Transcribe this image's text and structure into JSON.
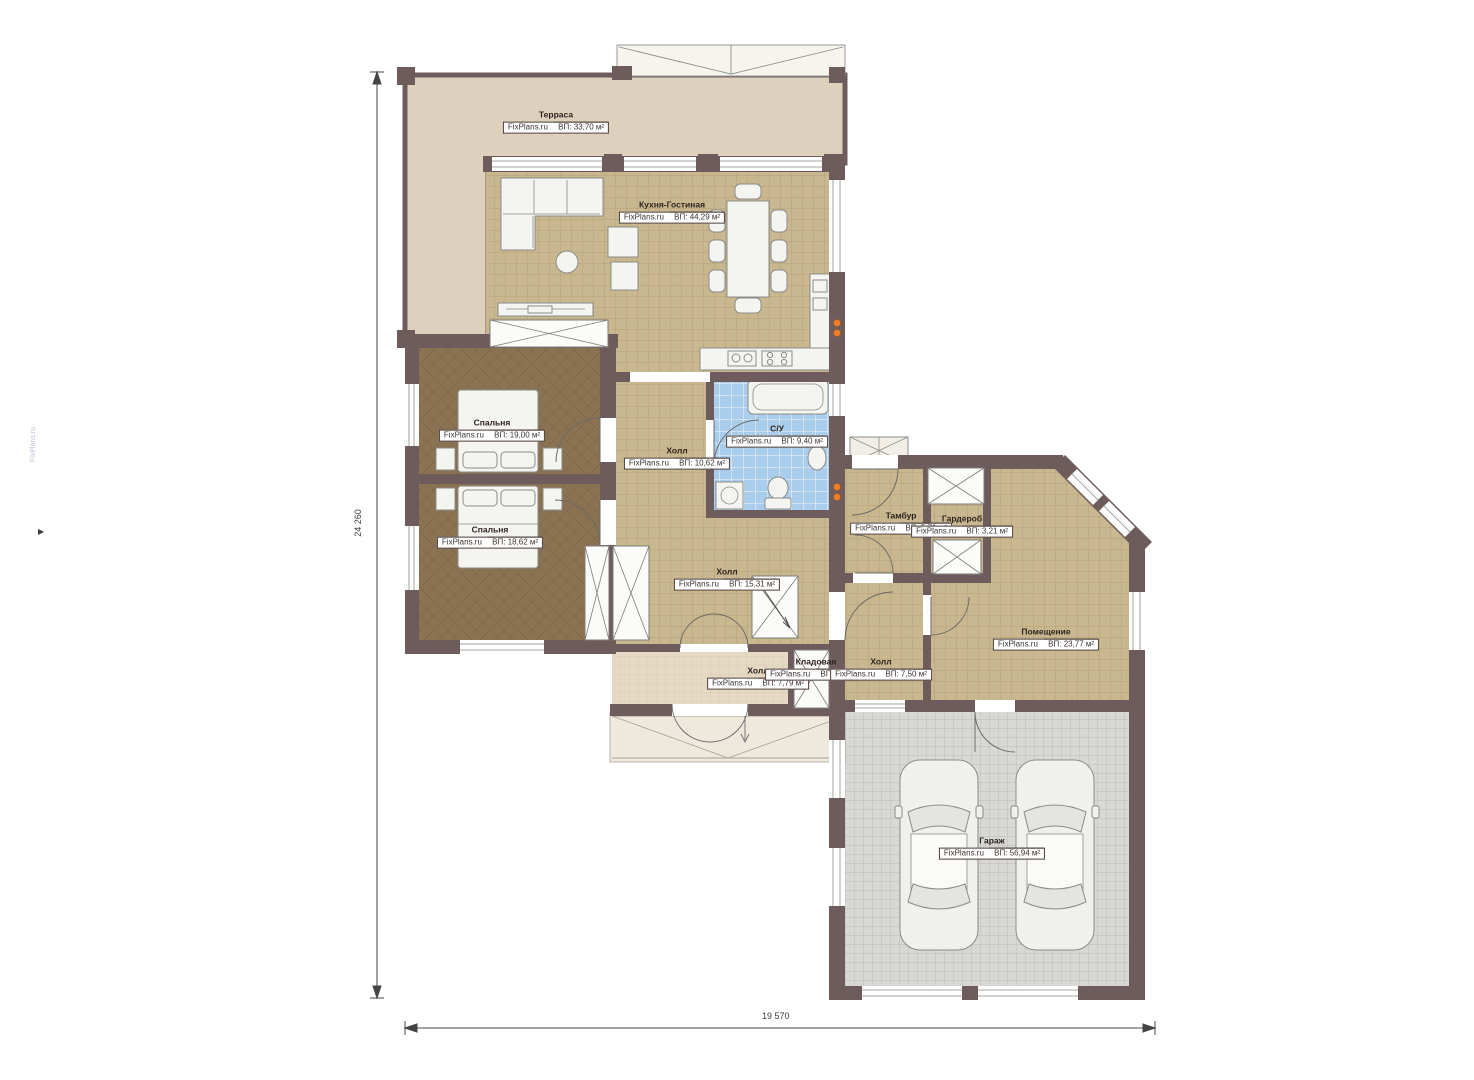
{
  "plan": {
    "title": "План 1 этажа",
    "brand": "FixPlans.ru",
    "watermark": "FixPlans.ru"
  },
  "dimensions": {
    "left_vertical": "24 260",
    "bottom_horizontal": "19 570"
  },
  "rooms": [
    {
      "name": "Терраса",
      "brand": "FixPlans.ru",
      "area": "ВП: 33,70 м²"
    },
    {
      "name": "Кухня-Гостиная",
      "brand": "FixPlans.ru",
      "area": "ВП: 44,29 м²"
    },
    {
      "name": "Спальня",
      "brand": "FixPlans.ru",
      "area": "ВП: 19,00 м²"
    },
    {
      "name": "Спальня",
      "brand": "FixPlans.ru",
      "area": "ВП: 18,62 м²"
    },
    {
      "name": "Холл",
      "brand": "FixPlans.ru",
      "area": "ВП: 10,62 м²"
    },
    {
      "name": "С/У",
      "brand": "FixPlans.ru",
      "area": "ВП: 9,40 м²"
    },
    {
      "name": "Тамбур",
      "brand": "FixPlans.ru",
      "area": "ВП: 5,71 м²"
    },
    {
      "name": "Гардероб",
      "brand": "FixPlans.ru",
      "area": "ВП: 3,21 м²"
    },
    {
      "name": "Холл",
      "brand": "FixPlans.ru",
      "area": "ВП: 15,31 м²"
    },
    {
      "name": "Помещение",
      "brand": "FixPlans.ru",
      "area": "ВП: 23,77 м²"
    },
    {
      "name": "Холл",
      "brand": "FixPlans.ru",
      "area": "ВП: 7,79 м²"
    },
    {
      "name": "Кладовая",
      "brand": "FixPlans.ru",
      "area": "ВП: 0,91 м²"
    },
    {
      "name": "Холл",
      "brand": "FixPlans.ru",
      "area": "ВП: 7,50 м²"
    },
    {
      "name": "Гараж",
      "brand": "FixPlans.ru",
      "area": "ВП: 56,94 м²"
    }
  ],
  "colors": {
    "wall": "#6e5c5c",
    "terrace_floor": "#ddd1bd",
    "tile_floor": "#c9b78f",
    "bedroom_floor": "#8a7252",
    "bath_floor": "#a9cdea",
    "garage_floor": "#d8d8d6",
    "hall_floor": "#e6d9c4",
    "socket": "#ee7f2d"
  }
}
